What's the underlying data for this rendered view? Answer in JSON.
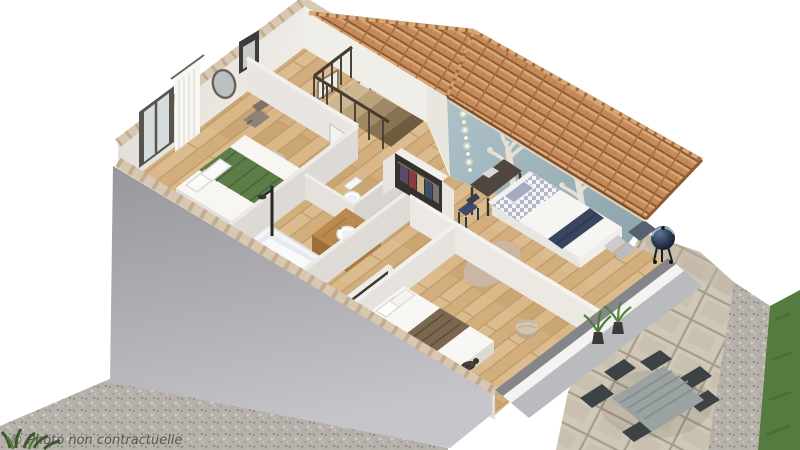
{
  "watermark": "© Photo non contractuelle",
  "scene": {
    "description": "3D isometric cutaway render of a house upper floor",
    "rooms": [
      {
        "name": "master-bedroom",
        "items": [
          "double-bed-green-runner",
          "round-rug",
          "low-dresser",
          "armchair",
          "window-with-curtain",
          "round-mirror"
        ]
      },
      {
        "name": "bathroom",
        "items": [
          "bathtub",
          "shower-column",
          "wood-vanity",
          "round-basin"
        ]
      },
      {
        "name": "wc",
        "items": [
          "toilet",
          "partition-stall"
        ]
      },
      {
        "name": "landing",
        "items": [
          "staircase",
          "railing",
          "framed-pictures",
          "open-wardrobe-clothes"
        ]
      },
      {
        "name": "kids-bedroom",
        "items": [
          "blue-accent-wall",
          "tree-decals",
          "string-lights",
          "desk",
          "small-chair",
          "single-bed-gingham",
          "round-dotted-rug",
          "bed-end-cushions"
        ]
      },
      {
        "name": "bedroom-2",
        "items": [
          "double-bed-brown-throw",
          "blue-cushions",
          "pouf",
          "shoe-wardrobe",
          "cat-on-bed"
        ]
      }
    ],
    "exterior": [
      "terracotta-tile-roof",
      "grey-exterior-walls",
      "gravel-ground",
      "paved-terrace",
      "dining-table",
      "six-chairs",
      "potted-grasses",
      "kettle-barbecue",
      "lawn-strip",
      "corner-plant"
    ]
  },
  "palette": {
    "background": "#ffffff",
    "roof_tile": "#c58a5a",
    "roof_shadow": "#8d5a33",
    "roof_highlight": "#d9a877",
    "wall_white": "#edeae5",
    "wall_grey_exterior": "#a8a7ab",
    "coping_beige": "#d8c8b2",
    "floor_wood": "#d9b787",
    "accent_wall_blue": "#a3b7be",
    "tree_decal": "#e6e0d4",
    "bed_green": "#5c7d47",
    "bed_navy": "#3a4560",
    "blanket_brown": "#7b6750",
    "gravel": "#b7b1ab",
    "paver": "#c9c0b0",
    "grass": "#567b40",
    "watermark_color": "#4b4b47"
  }
}
